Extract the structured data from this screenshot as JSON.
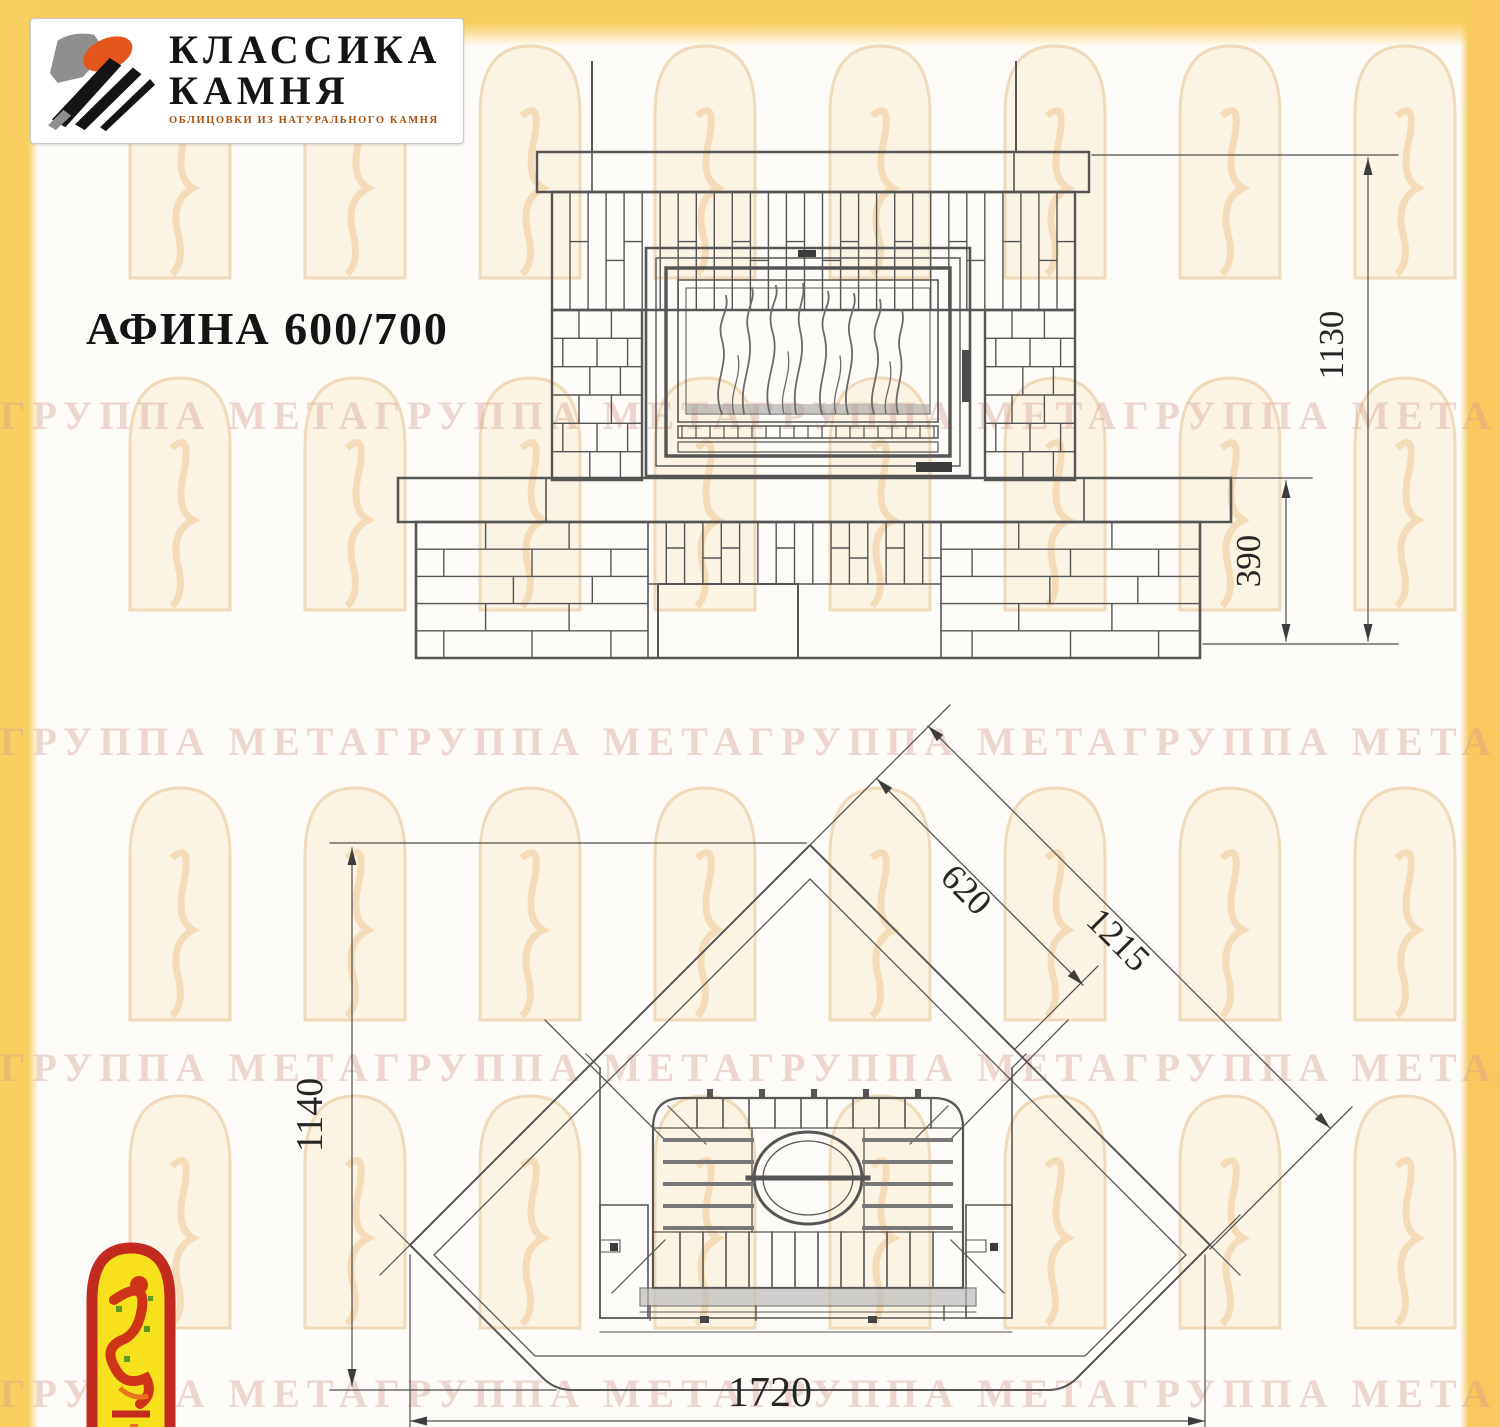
{
  "branding": {
    "logo_line1": "КЛАССИКА",
    "logo_line2": "КАМНЯ",
    "logo_tagline": "ОБЛИЦОВКИ ИЗ НАТУРАЛЬНОГО КАМНЯ"
  },
  "title": "АФИНА 600/700",
  "front_view": {
    "dim_total_height": "1130",
    "dim_base_height": "390"
  },
  "plan_view": {
    "dim_depth": "1140",
    "dim_width": "1720",
    "dim_firebox_front": "620",
    "dim_side_edge": "1215"
  },
  "watermark": {
    "row_text": "ГРУППА МЕТАГРУППА МЕТАГРУППА МЕТАГРУППА МЕТАГРУППА МЕТАГРУППА МЕТА"
  },
  "colors": {
    "accent_yellow": "#f8cd5f",
    "logo_orange": "#e4561c",
    "emblem_red": "#c22a20",
    "emblem_yellow": "#f6e11c",
    "line": "#4f4f4f"
  }
}
